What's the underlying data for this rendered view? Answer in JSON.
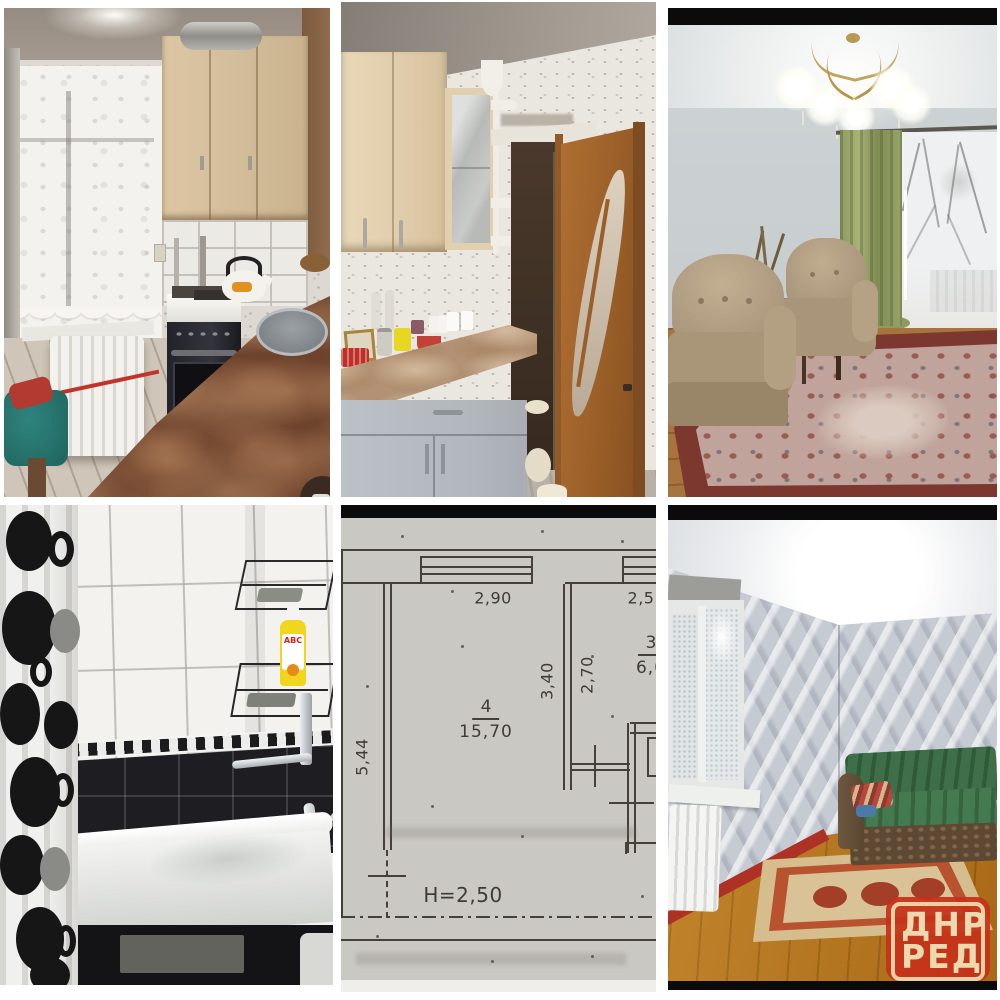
{
  "collage": {
    "background": "#ffffff",
    "tiles": [
      {
        "id": "kitchen-photo-window"
      },
      {
        "id": "kitchen-photo-door"
      },
      {
        "id": "living-room-photo"
      },
      {
        "id": "bathroom-photo"
      },
      {
        "id": "floor-plan-scan"
      },
      {
        "id": "room-sofa-photo"
      }
    ]
  },
  "floor_plan": {
    "dim_top": "2,90",
    "dim_top_right": "2,5",
    "dim_left_wall": "5,44",
    "dim_inner_left": "3,40",
    "dim_inner_right": "2,70",
    "room4_number": "4",
    "room4_area": "15,70",
    "room3_number": "3",
    "room3_area": "6,0",
    "ceiling_height": "H=2,50"
  },
  "watermark": {
    "line1": "ДНР",
    "line2": "РЕД",
    "background": "#c6301a",
    "foreground": "#ecd9ae"
  },
  "bathroom": {
    "bottle_label": "ABC"
  }
}
